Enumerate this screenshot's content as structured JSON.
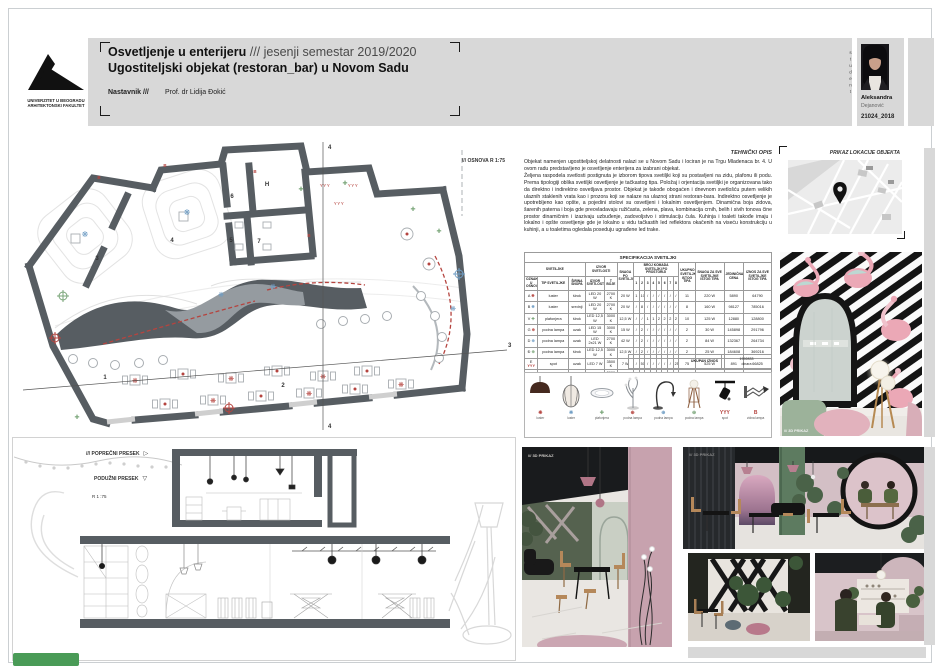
{
  "colors": {
    "accent-red": "#b5443f",
    "accent-blue": "#6f9dc4",
    "accent-green": "#79a578",
    "wall-gray": "#575d62",
    "band-gray": "#d8d8d8",
    "badge-green": "#4a9b57"
  },
  "header": {
    "title_main": "Osvetljenje u enterijeru",
    "title_suffix": "/// jesenji semestar 2019/2020",
    "subtitle": "Ugostiteljski objekat (restoran_bar) u Novom Sadu",
    "teacher_label": "Nastavnik ///",
    "teacher_name": "Prof. dr Lidija Đokić",
    "logo_line1": "UNIVERZITET U BEOGRADU",
    "logo_line2": "ARHITEKTONSKI FAKULTET"
  },
  "student": {
    "vertical_label": "student",
    "first_name": "Aleksandra",
    "last_name": "Dejanović",
    "id": "21024_2018"
  },
  "plan": {
    "label": "/// OSNOVA R 1:75",
    "room_numbers": [
      "1",
      "2",
      "3",
      "4",
      "5",
      "6",
      "7"
    ],
    "kitchen_label": "H",
    "section_mark_transverse": "3",
    "section_mark_longitudinal": "4"
  },
  "tech": {
    "heading": "TEHNIČKI OPIS",
    "p1": "Objekat namenjen ugostiteljskoj delatnosti nalazi se u Novom Sadu i lociran je na Trgu Mladenaca br. 4. U ovom radu predstavljeno je osvetljenje enterijera za izabrani objekat.",
    "p2": "Željena raspodela svetlosti postignuta je izborom tipova svetiljki koji su postavljeni na zidu, plafonu ili podu. Prema tipologiji oblika svetiljki osvetljenje je tačkastog tipa. Položaj i orjentacija svetiljki je organizovana tako da direktno i indirektno osvetljava prostor. Objekat je takođe obogaćen i dnevnom svetlošću putem velikih ulaznih staklenih vrata kao i prozora koji se nalaze na ulaznoj strani restoran-bara. Indirektno osvetljenje je upotrebljeno kao opšte, a pojedini stolovi su osvetljeni i lokalnim osvetljenjem. Dinamična boja zidova, šarenih paterna i boja gde preovladavaju ružičasta, zelena, plava, kombinacija crnih, belih i sivih tonova čine prostor dinamičnim i izazivaju uzbuđenje, zadovoljstvo i stimulaciju čula. Kuhinja i toaleti takođe imaju i lokalno i opšte osvetljenje gde je lokalno u vidu tačkastih led reflektora okačenih na viseću konstrukciju u kuhinji, a u toaletima ogledala poseduju ugrađene led trake."
  },
  "spec_table": {
    "title": "SPECIFIKACIJA SVETILJKI",
    "group_svetiljke": "SVETILJKE",
    "group_izvor": "IZVOR SVETLOSTI",
    "group_broj": "BROJ KOMADA SVETILJKI PO PROSTORIJI",
    "col_oznaka": "OZNAKA U OSNOVAMA",
    "col_tip": "TIP SVETILJKE",
    "col_snop": "ŠIRINA SNOPA",
    "col_izvor": "IZVOR SVETLOSTI",
    "col_t_boje": "T BOJE",
    "col_snaga": "SNAGA PO SVETILJCI",
    "room_cols": [
      "1",
      "2",
      "3",
      "4",
      "5",
      "6",
      "7",
      "8"
    ],
    "col_ukupno": "UKUPNO SVETILJKI ISTOG TIPA",
    "col_snaga_sve": "SNAGA ZA SVE SVETILJKE ISTOG TIPA",
    "col_cena": "JEDINIČNA CENA",
    "col_iznos": "IZNOS ZA SVE SVETILJKE ISTOG TIPA",
    "rows": [
      {
        "oznaka": "A",
        "symbol": "❋",
        "symbol_color": "#b5443f",
        "tip": "luster",
        "snop": "širok",
        "izvor": "LED 20 W",
        "t_boje": "2700 K",
        "snaga": "20 W",
        "counts": [
          "1",
          "10",
          "/",
          "/",
          "/",
          "/",
          "/",
          "/"
        ],
        "ukupno": "11",
        "snaga_sve": "220 W",
        "cena": "5890",
        "iznos": "64790"
      },
      {
        "oznaka": "B",
        "symbol": "❋",
        "symbol_color": "#6f9dc4",
        "tip": "luster",
        "snop": "srednji",
        "izvor": "LED 20 W",
        "t_boje": "2700 K",
        "snaga": "20 W",
        "counts": [
          "/",
          "8",
          "/",
          "/",
          "/",
          "/",
          "/",
          "/"
        ],
        "ukupno": "8",
        "snaga_sve": "160 W",
        "cena": "98127",
        "iznos": "785016"
      },
      {
        "oznaka": "V",
        "symbol": "✚",
        "symbol_color": "#79a578",
        "tip": "plafonjera",
        "snop": "širok",
        "izvor": "LED 12,5 W",
        "t_boje": "3000 K",
        "snaga": "12,5 W",
        "counts": [
          "/",
          "/",
          "1",
          "1",
          "2",
          "2",
          "2",
          "2"
        ],
        "ukupno": "10",
        "snaga_sve": "125 W",
        "cena": "12880",
        "iznos": "128800"
      },
      {
        "oznaka": "G",
        "symbol": "⊕",
        "symbol_color": "#b5443f",
        "tip": "podna lampa",
        "snop": "uzak",
        "izvor": "LED 15 W",
        "t_boje": "3000 K",
        "snaga": "15 W",
        "counts": [
          "/",
          "2",
          "/",
          "/",
          "/",
          "/",
          "/",
          "/"
        ],
        "ukupno": "2",
        "snaga_sve": "30 W",
        "cena": "145898",
        "iznos": "291796"
      },
      {
        "oznaka": "D",
        "symbol": "⊕",
        "symbol_color": "#6f9dc4",
        "tip": "podna lampa",
        "snop": "uzak",
        "izvor": "LED 2x21 W",
        "t_boje": "2700 K",
        "snaga": "42 W",
        "counts": [
          "/",
          "2",
          "/",
          "/",
          "/",
          "/",
          "/",
          "/"
        ],
        "ukupno": "2",
        "snaga_sve": "84 W",
        "cena": "132367",
        "iznos": "264734"
      },
      {
        "oznaka": "Đ",
        "symbol": "⊕",
        "symbol_color": "#79a578",
        "tip": "podna lampa",
        "snop": "širok",
        "izvor": "LED 12,5 W",
        "t_boje": "3000 K",
        "snaga": "12,5 W",
        "counts": [
          "/",
          "2",
          "/",
          "/",
          "/",
          "/",
          "/",
          "/"
        ],
        "ukupno": "2",
        "snaga_sve": "25 W",
        "cena": "184608",
        "iznos": "369216"
      },
      {
        "oznaka": "E",
        "symbol": "YYY",
        "symbol_color": "#b5443f",
        "tip": "spot",
        "snop": "uzak",
        "izvor": "LED 7 W",
        "t_boje": "3500 K",
        "snaga": "7 W",
        "counts": [
          "/",
          "50",
          "/",
          "/",
          "/",
          "/",
          "/",
          "25"
        ],
        "ukupno": "75",
        "snaga_sve": "525 W",
        "cena": "891",
        "iznos": "66825"
      },
      {
        "oznaka": "Ž",
        "symbol": "B",
        "symbol_color": "#b5443f",
        "tip": "zidna lampa",
        "snop": "srednji",
        "izvor": "LED 8 W",
        "t_boje": "3000 K",
        "snaga": "8 W",
        "counts": [
          "/",
          "/",
          "3",
          "/",
          "4",
          "2",
          "2",
          "/"
        ],
        "ukupno": "11",
        "snaga_sve": "88 W",
        "cena": "8829",
        "iznos": "97119"
      }
    ],
    "totals": {
      "count_label": "UKUPNO SVETILJKI",
      "count_value": "121",
      "power_label": "UKUPNA SNAGA",
      "power_value": "1255 W",
      "sum_label": "UKUPAN IZNOS",
      "sum_value": "1992833",
      "sum_unit": "dinara"
    }
  },
  "lamps": {
    "items": [
      {
        "label": "luster",
        "symbol": "❋",
        "symbol_color": "#b5443f"
      },
      {
        "label": "luster",
        "symbol": "❋",
        "symbol_color": "#6f9dc4"
      },
      {
        "label": "plafonjera",
        "symbol": "✚",
        "symbol_color": "#79a578"
      },
      {
        "label": "podna lampa",
        "symbol": "⊕",
        "symbol_color": "#b5443f"
      },
      {
        "label": "podna lampa",
        "symbol": "⊕",
        "symbol_color": "#6f9dc4"
      },
      {
        "label": "podna lampa",
        "symbol": "⊕",
        "symbol_color": "#79a578"
      },
      {
        "label": "spot",
        "symbol": "YYY",
        "symbol_color": "#b5443f"
      },
      {
        "label": "zidna lampa",
        "symbol": "B",
        "symbol_color": "#b5443f"
      }
    ]
  },
  "map_panel": {
    "title": "PRIKAZ LOKACIJE OBJEKTA"
  },
  "renders": {
    "caption": "/// 3D PRIKAZ"
  },
  "sections": {
    "transverse_label": "/// POPREČNI PRESEK",
    "longitudinal_label": "PODUŽNI PRESEK",
    "scale": "R 1 :75",
    "transverse_marker": "▷",
    "longitudinal_marker": "▽"
  }
}
